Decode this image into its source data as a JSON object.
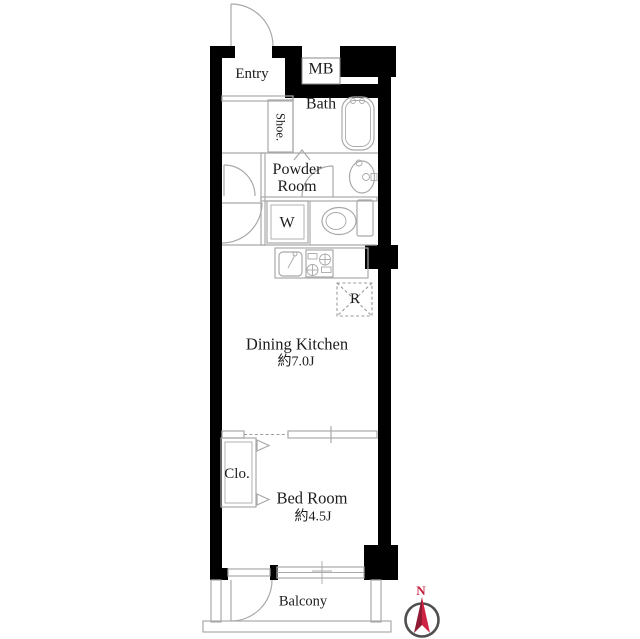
{
  "floor_plan": {
    "rooms": {
      "entry": {
        "label": "Entry"
      },
      "meter_box": {
        "label": "MB"
      },
      "bath": {
        "label": "Bath"
      },
      "shoe_closet": {
        "label": "Shoe."
      },
      "powder_room": {
        "label": "Powder Room"
      },
      "washing_machine": {
        "label": "W"
      },
      "refrigerator_space": {
        "label": "R"
      },
      "dining_kitchen": {
        "label": "Dining Kitchen",
        "size": "約7.0J"
      },
      "closet": {
        "label": "Clo."
      },
      "bed_room": {
        "label": "Bed Room",
        "size": "約4.5J"
      },
      "balcony": {
        "label": "Balcony"
      }
    },
    "compass": {
      "north_label": "N"
    },
    "colors": {
      "wall": "#000000",
      "interior_line": "#a9a9a9",
      "text": "#1c1c1c",
      "compass_red": "#c41f3c"
    }
  }
}
